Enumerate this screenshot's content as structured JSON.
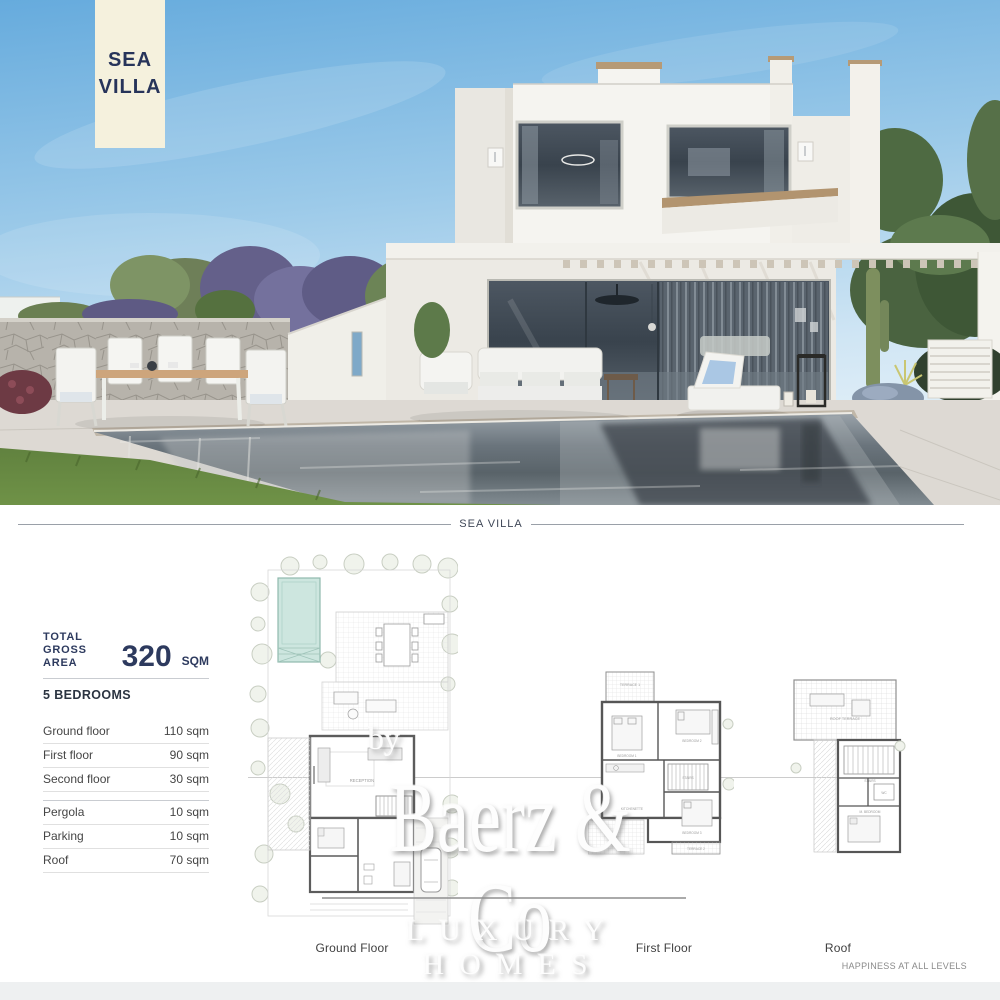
{
  "hero": {
    "badge": {
      "line1": "SEA",
      "line2": "VILLA"
    },
    "scene": "rendering of a white two-storey sea villa with pool, pergola, garden and outdoor furniture"
  },
  "divider": {
    "label": "SEA VILLA"
  },
  "specs": {
    "total": {
      "label_line1": "TOTAL",
      "label_line2": "GROSS AREA",
      "value": "320",
      "unit": "SQM"
    },
    "bedrooms": "5 BEDROOMS",
    "areas_main": [
      {
        "label": "Ground floor",
        "value": "110 sqm"
      },
      {
        "label": "First floor",
        "value": "90 sqm"
      },
      {
        "label": "Second floor",
        "value": "30 sqm"
      }
    ],
    "areas_extra": [
      {
        "label": "Pergola",
        "value": "10 sqm"
      },
      {
        "label": "Parking",
        "value": "10 sqm"
      },
      {
        "label": "Roof",
        "value": "70 sqm"
      }
    ]
  },
  "floorplans": {
    "ground_label": "Ground Floor",
    "first_label": "First Floor",
    "roof_label": "Roof",
    "ground_rooms": {
      "reception": "RECEPTION"
    },
    "first_rooms": {
      "terrace1": "TERRACE 1",
      "bedroom1": "BEDROOM 1",
      "bedroom2": "BEDROOM 2",
      "stairs": "STAIRS",
      "kitchenette": "KITCHENETTE",
      "bedroom3": "BEDROOM 3",
      "terrace2": "TERRACE 2"
    },
    "roof_rooms": {
      "terrace": "ROOF TERRACE",
      "stairs": "STAIRS",
      "wc": "WC",
      "bedroom": "M. BEDROOM"
    }
  },
  "watermark": {
    "by": "by",
    "brand": "Baerz & Co",
    "tagline": "LUXURY HOMES"
  },
  "footer": {
    "tagline": "HAPPINESS AT ALL LEVELS"
  },
  "colors": {
    "navy": "#2d3a5e",
    "cream": "#f5f1dd",
    "sky_blue": "#66abdd",
    "pool_plan_teal": "#cde6df",
    "wood_accent": "#b69a76",
    "water_gray": "#5f6970"
  }
}
